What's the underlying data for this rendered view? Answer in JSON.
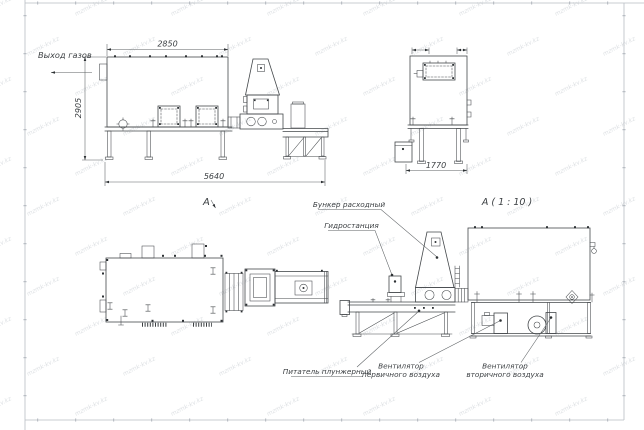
{
  "drawing": {
    "watermark": "mzmk-kv.kz",
    "colors": {
      "line": "#44484b",
      "dim": "#5c6063",
      "text": "#3b3f42",
      "watermark": "#c9ced3"
    },
    "views": {
      "side": {
        "gas_outlet_label": "Выход газов",
        "dim_top_width": "2850",
        "dim_height": "2905",
        "dim_total_length": "5640",
        "view_arrow_label": "A"
      },
      "front": {
        "dim_width": "1770"
      },
      "detail": {
        "title": "A ( 1 : 10 )",
        "callouts": {
          "hopper": "Бункер расходный",
          "hydrostation": "Гидростанция",
          "feeder": "Питатель плунжерный",
          "primary_fan": [
            "Вентилятор",
            "первичного воздуха"
          ],
          "secondary_fan": [
            "Вентилятор",
            "вторичного воздуха"
          ]
        }
      }
    }
  }
}
